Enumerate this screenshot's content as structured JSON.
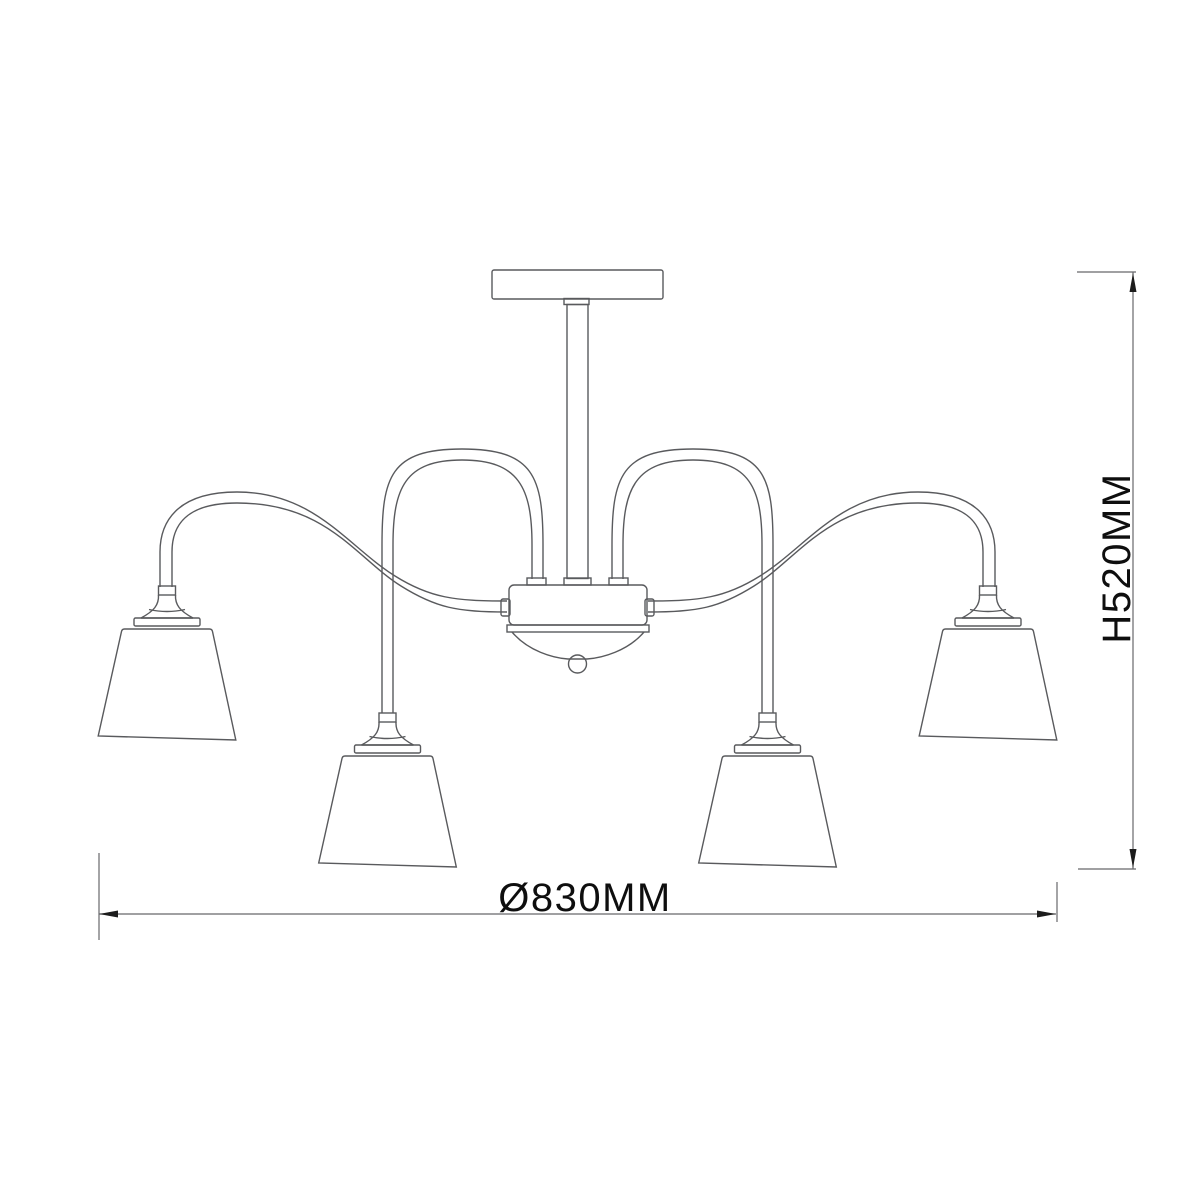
{
  "diagram": {
    "type": "technical-line-drawing",
    "subject": "four-arm ceiling light fixture with cone shades",
    "background": "#ffffff",
    "line_color": "#595a5d",
    "dimension_line_color": "#67686b",
    "arrow_color": "#1c1c1c",
    "text_color": "#0e0e0e",
    "labels": {
      "diameter": "Ø830MM",
      "height": "H520MM"
    },
    "fixture": {
      "shade_count": 4,
      "arm_count": 4
    }
  }
}
